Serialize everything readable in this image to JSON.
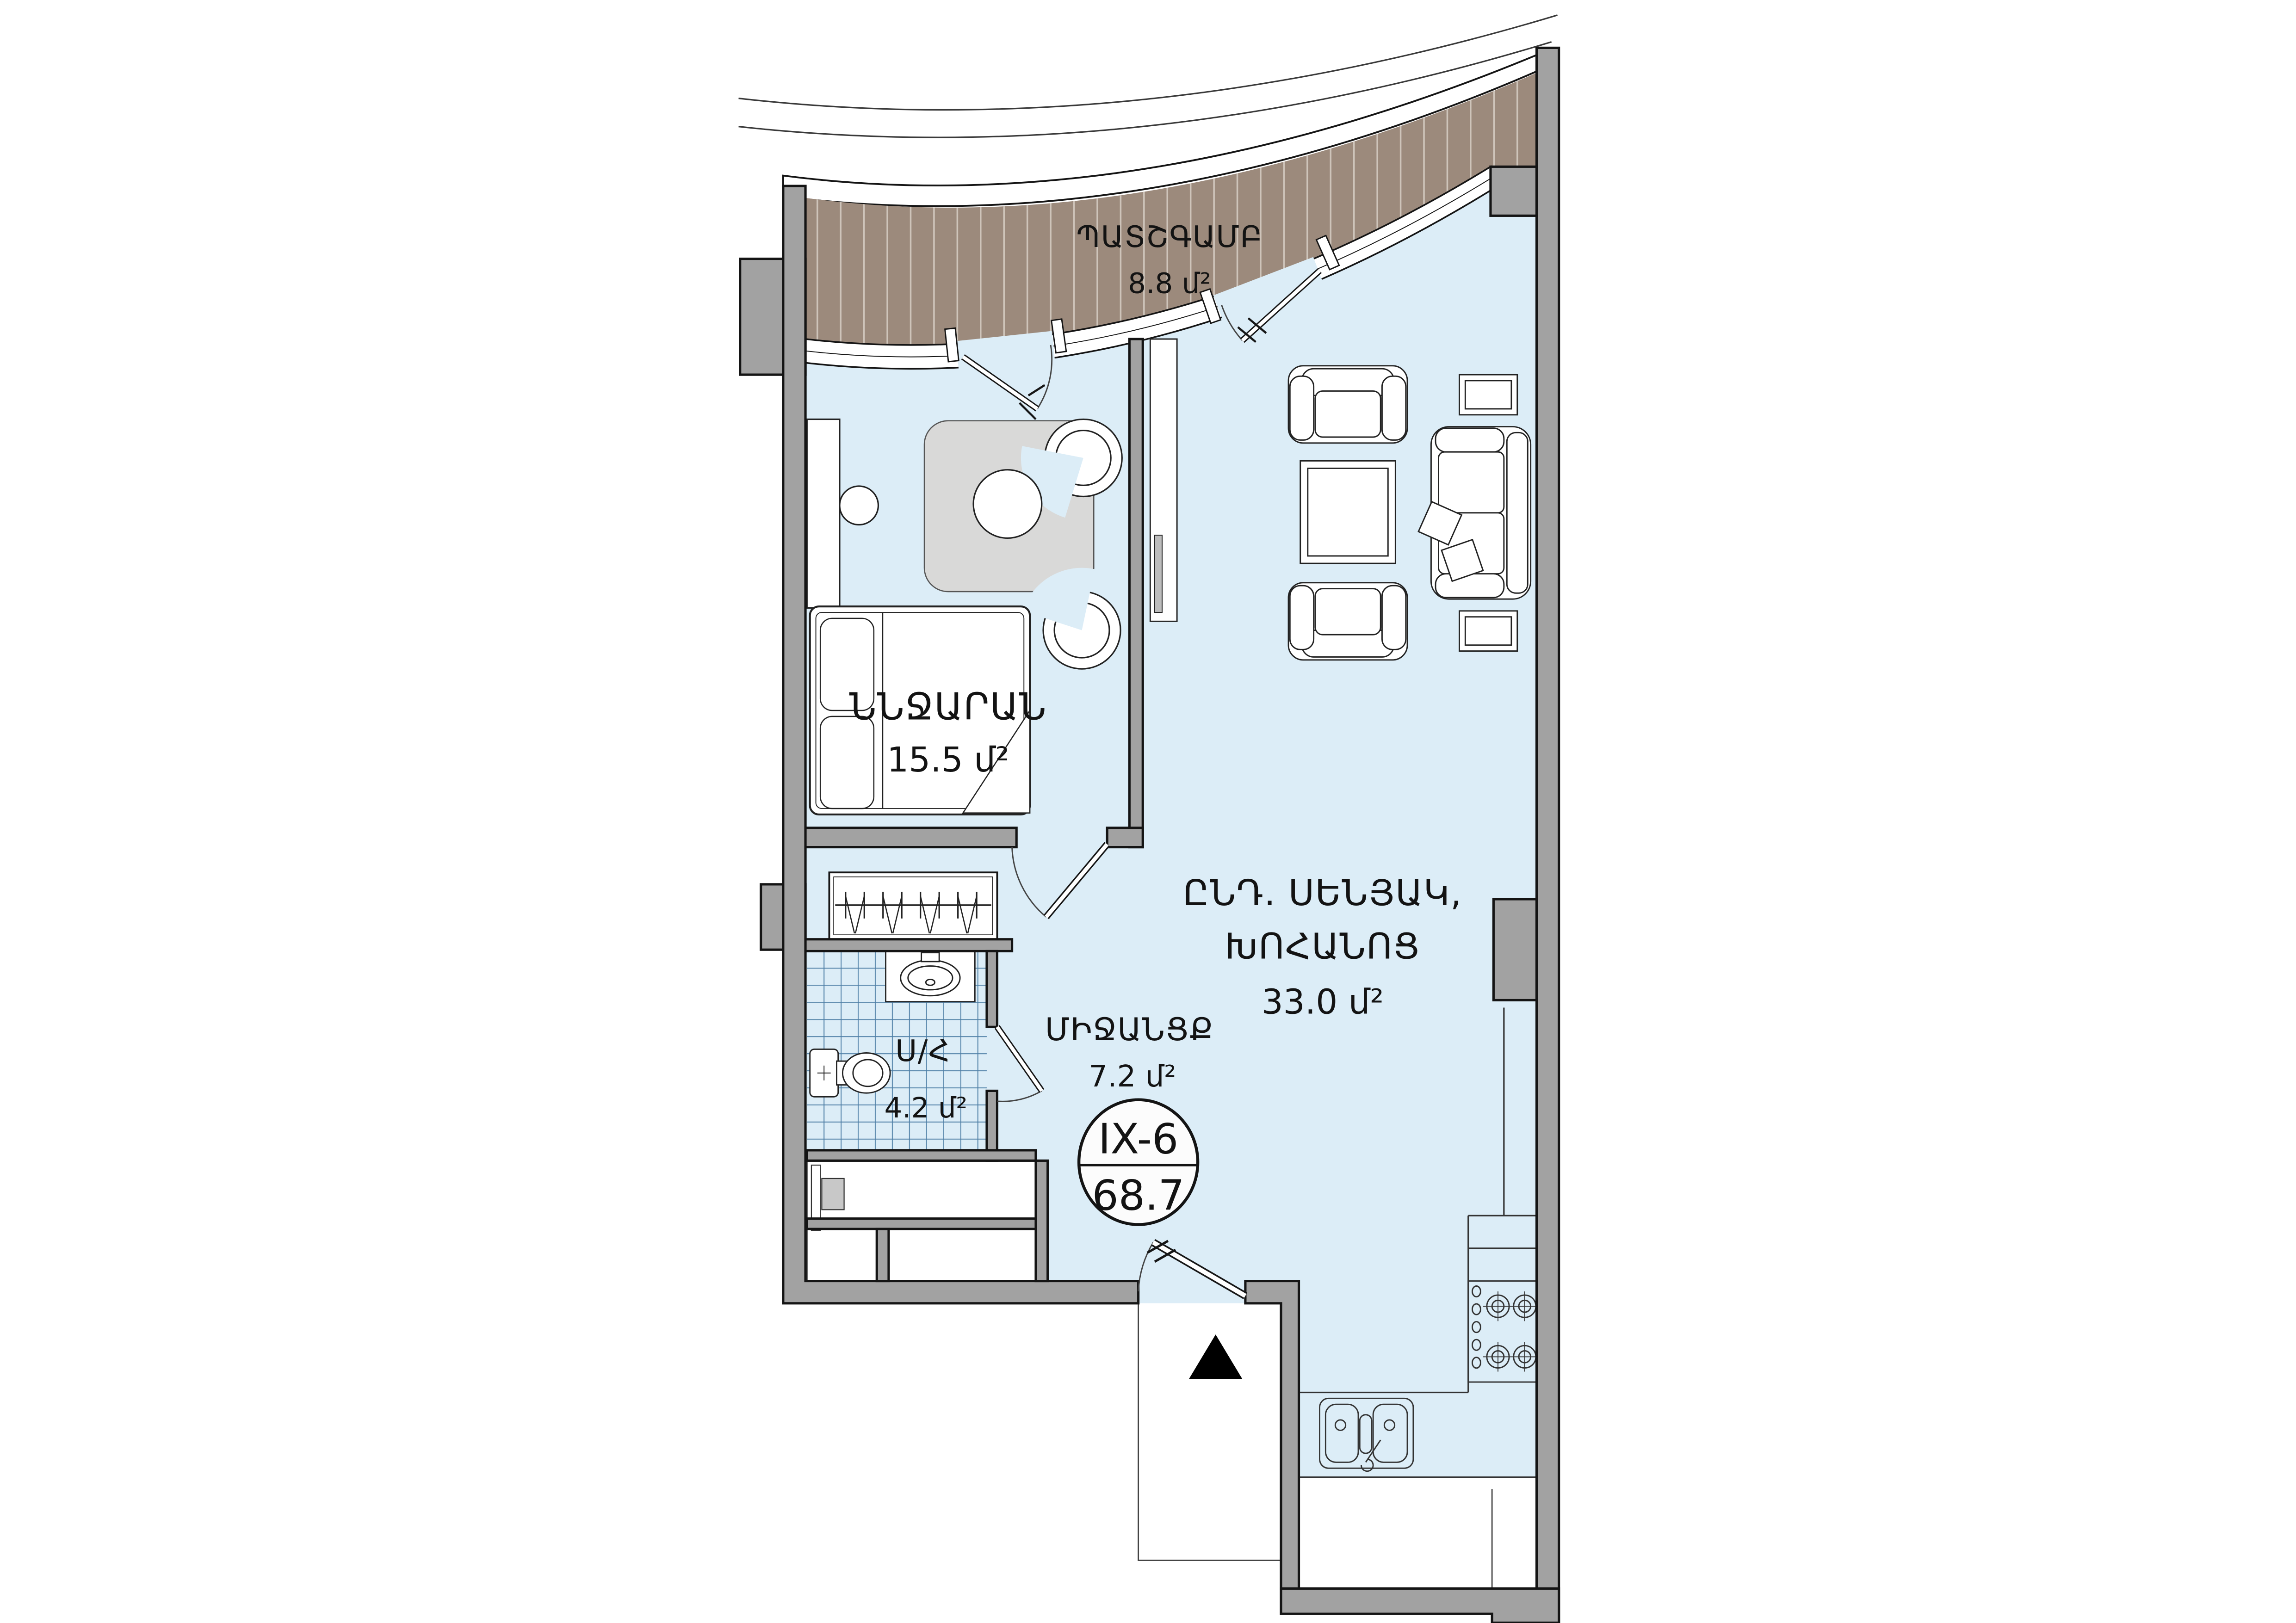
{
  "badge": {
    "unit": "IX-6",
    "area": "68.7"
  },
  "rooms": {
    "balcony": {
      "label": "ՊԱՏՇԳԱՄԲ",
      "area": "8.8 մ²"
    },
    "bedroom": {
      "label": "ՆՆՋԱՐԱՆ",
      "area": "15.5 մ²"
    },
    "living": {
      "label_line1": "ԸՆԴ. ՍԵՆՅԱԿ,",
      "label_line2": "ԽՈՀԱՆՈՑ",
      "area": "33.0 մ²"
    },
    "corridor": {
      "label": "ՄԻՋԱՆՑՔ",
      "area": "7.2 մ²"
    },
    "bathroom": {
      "label": "Ս/Հ",
      "area": "4.2 մ²"
    }
  },
  "colors": {
    "floor": "#dcedf7",
    "balcony_deck": "#9c8a7c",
    "deck_stripe": "#cec4ba",
    "wall": "#a2a2a2",
    "wall_outline": "#141414",
    "rug": "#d9d9d8",
    "tile_line": "#4f7fa6",
    "furniture_line": "#222222",
    "white": "#ffffff",
    "arrow": "#000000"
  }
}
